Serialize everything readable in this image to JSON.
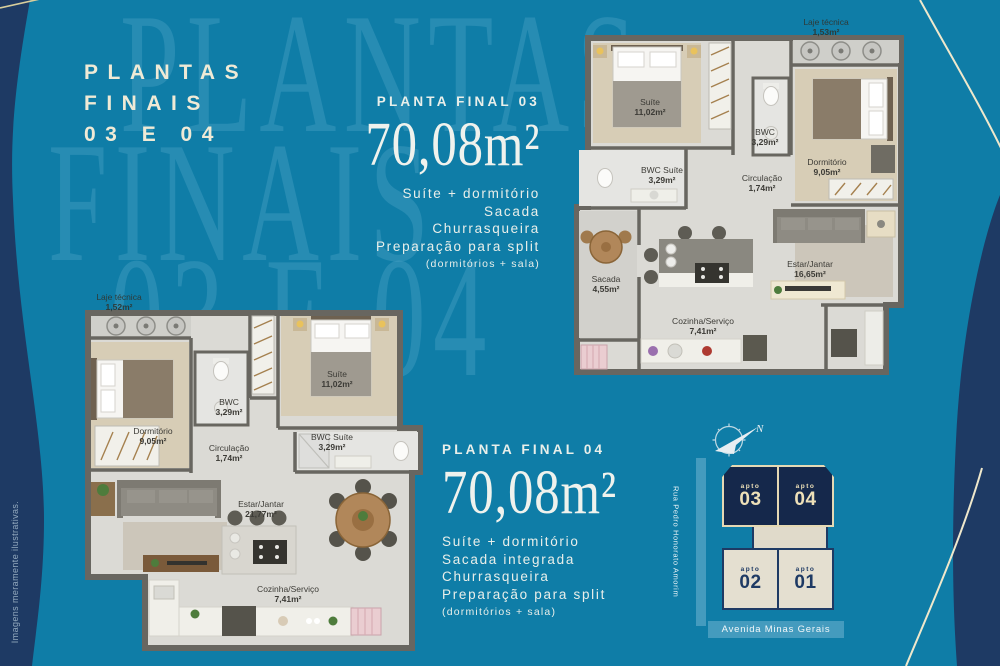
{
  "title": {
    "line1": "PLANTAS",
    "line2": "FINAIS",
    "line3": "03 E 04"
  },
  "watermark": {
    "line1": "PLANTAS",
    "line2": "FINAIS",
    "line3": "03 E 04"
  },
  "disclaimer": "Imagens meramente ilustrativas.",
  "colors": {
    "background": "#0F7DA7",
    "navy": "#1E3A64",
    "cream": "#EFEAD6",
    "street_bar": "#449BBE",
    "unit_dark": "#15284B",
    "unit_light": "#E4DFD0"
  },
  "plan03": {
    "heading": "PLANTA FINAL 03",
    "area": "70,08m²",
    "features": [
      "Suíte + dormitório",
      "Sacada",
      "Churrasqueira",
      "Preparação para split"
    ],
    "features_note": "(dormitórios + sala)",
    "laje": {
      "name": "Laje técnica",
      "area": "1,53m²"
    },
    "rooms": {
      "suite": {
        "name": "Suíte",
        "area": "11,02m²"
      },
      "bwc": {
        "name": "BWC",
        "area": "3,29m²"
      },
      "dormitorio": {
        "name": "Dormitório",
        "area": "9,05m²"
      },
      "bwc_suite": {
        "name": "BWC Suíte",
        "area": "3,29m²"
      },
      "circulacao": {
        "name": "Circulação",
        "area": "1,74m²"
      },
      "sacada": {
        "name": "Sacada",
        "area": "4,55m²"
      },
      "estar": {
        "name": "Estar/Jantar",
        "area": "16,65m²"
      },
      "cozinha": {
        "name": "Cozinha/Serviço",
        "area": "7,41m²"
      }
    }
  },
  "plan04": {
    "heading": "PLANTA FINAL 04",
    "area": "70,08m²",
    "features": [
      "Suíte + dormitório",
      "Sacada integrada",
      "Churrasqueira",
      "Preparação para split"
    ],
    "features_note": "(dormitórios + sala)",
    "laje": {
      "name": "Laje técnica",
      "area": "1,52m²"
    },
    "rooms": {
      "suite": {
        "name": "Suíte",
        "area": "11,02m²"
      },
      "bwc": {
        "name": "BWC",
        "area": "3,29m²"
      },
      "dormitorio": {
        "name": "Dormitório",
        "area": "9,05m²"
      },
      "bwc_suite": {
        "name": "BWC Suíte",
        "area": "3,29m²"
      },
      "circulacao": {
        "name": "Circulação",
        "area": "1,74m²"
      },
      "estar": {
        "name": "Estar/Jantar",
        "area": "21,77m²"
      },
      "cozinha": {
        "name": "Cozinha/Serviço",
        "area": "7,41m²"
      }
    }
  },
  "keyplan": {
    "compass_letter": "N",
    "streets": {
      "left": "Rua Pedro Honorato Amorim",
      "bottom": "Avenida Minas Gerais"
    },
    "units": [
      {
        "label": "apto",
        "number": "03"
      },
      {
        "label": "apto",
        "number": "04"
      },
      {
        "label": "apto",
        "number": "02"
      },
      {
        "label": "apto",
        "number": "01"
      }
    ]
  }
}
